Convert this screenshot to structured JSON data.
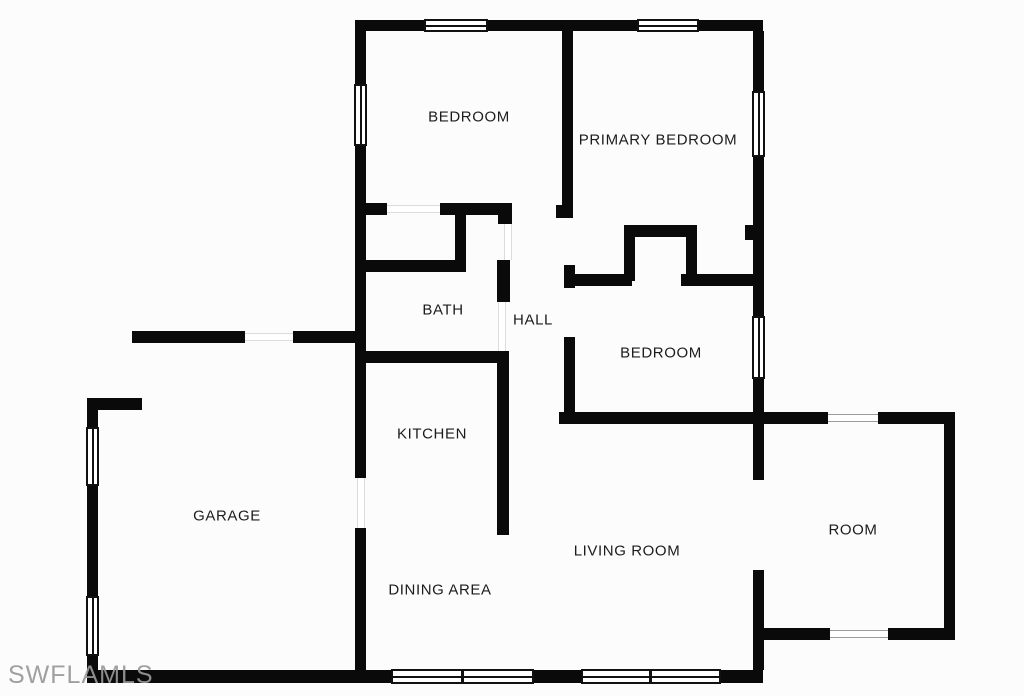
{
  "plan": {
    "background_color": "#fcfcfc",
    "wall_color": "#0a0a0a",
    "watermark": {
      "text": "SWFLAMLS",
      "color": "#989898"
    }
  },
  "rooms": {
    "bedroom_top": {
      "label": "BEDROOM"
    },
    "primary_bedroom": {
      "label": "PRIMARY BEDROOM"
    },
    "bath": {
      "label": "BATH"
    },
    "hall": {
      "label": "HALL"
    },
    "bedroom_right": {
      "label": "BEDROOM"
    },
    "kitchen": {
      "label": "KITCHEN"
    },
    "garage": {
      "label": "GARAGE"
    },
    "dining_area": {
      "label": "DINING AREA"
    },
    "living_room": {
      "label": "LIVING ROOM"
    },
    "room": {
      "label": "ROOM"
    }
  }
}
